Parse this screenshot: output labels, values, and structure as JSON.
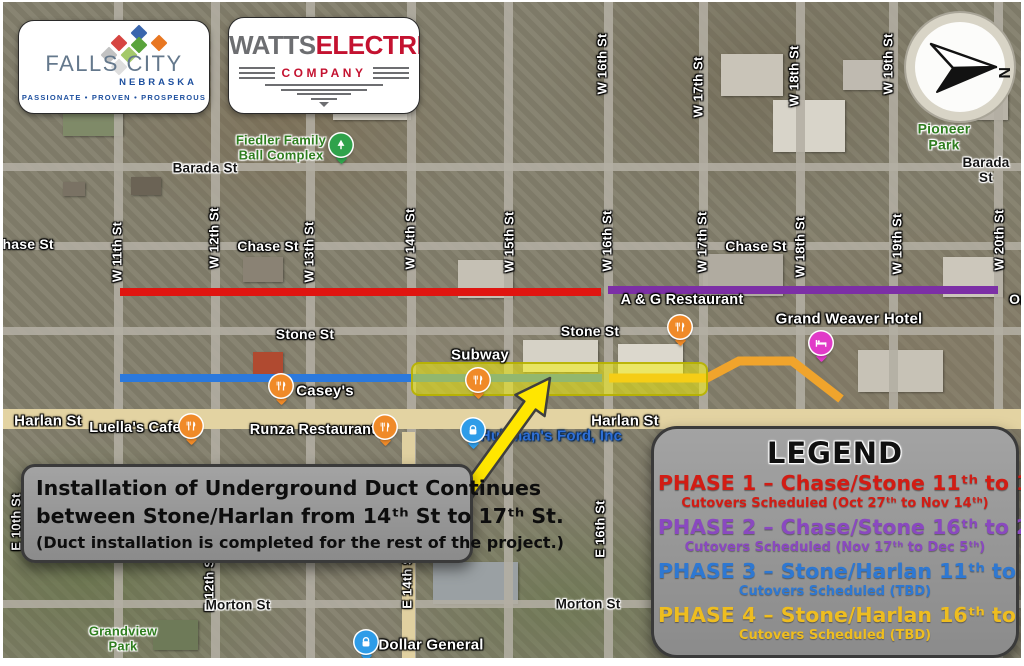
{
  "logos": {
    "falls_city": {
      "name": "FALLS CITY",
      "state": "NEBRASKA",
      "tagline": "PASSIONATE • PROVEN • PROSPEROUS"
    },
    "watts": {
      "word1": "WATTS",
      "word2": "ELECTRIC",
      "word3": "COMPANY"
    }
  },
  "compass": {
    "north_label": "N"
  },
  "annotation": {
    "line1": "Installation of Underground Duct Continues",
    "line2": "between Stone/Harlan from 14ᵗʰ St to 17ᵗʰ St.",
    "line3": "(Duct installation is completed for the rest of the project.)"
  },
  "legend": {
    "title": "LEGEND",
    "phases": [
      {
        "label": "PHASE 1 – Chase/Stone 11ᵗʰ to 16ᵗʰ",
        "schedule": "Cutovers Scheduled (Oct 27ᵗʰ to Nov 14ᵗʰ)",
        "color": "#d21c14"
      },
      {
        "label": "PHASE 2 – Chase/Stone 16ᵗʰ to 20ᵗʰ",
        "schedule": "Cutovers Scheduled (Nov 17ᵗʰ to Dec 5ᵗʰ)",
        "color": "#8a49c0"
      },
      {
        "label": "PHASE 3 – Stone/Harlan 11ᵗʰ to 16ᵗʰ",
        "schedule": "Cutovers Scheduled (TBD)",
        "color": "#2e78d2"
      },
      {
        "label": "PHASE 4 – Stone/Harlan 16ᵗʰ to 18ᵗʰ",
        "schedule": "Cutovers Scheduled (TBD)",
        "color": "#eebd20"
      }
    ]
  },
  "colors": {
    "phase1_line": "#e01510",
    "phase2_line": "#7c2fa6",
    "phase3_line": "#2b79dd",
    "phase4_line": "#f0a42c",
    "highlight_fill": "rgba(250,245,0,0.5)",
    "highlight_border": "rgba(182,176,0,0.9)",
    "arrow_fill": "#ffe600"
  },
  "map": {
    "labels": [
      {
        "text": "W 11th St",
        "x": 115,
        "y": 250,
        "v": true,
        "cls": "white",
        "size": 13,
        "name": "street-label-w-11th"
      },
      {
        "text": "W 12th St",
        "x": 212,
        "y": 236,
        "v": true,
        "cls": "white",
        "size": 13,
        "name": "street-label-w-12th"
      },
      {
        "text": "W 13th St",
        "x": 307,
        "y": 250,
        "v": true,
        "cls": "white",
        "size": 13,
        "name": "street-label-w-13th"
      },
      {
        "text": "W 14th St",
        "x": 408,
        "y": 237,
        "v": true,
        "cls": "white",
        "size": 13,
        "name": "street-label-w-14th"
      },
      {
        "text": "W 15th St",
        "x": 507,
        "y": 240,
        "v": true,
        "cls": "white",
        "size": 13,
        "name": "street-label-w-15th"
      },
      {
        "text": "W 16th St",
        "x": 605,
        "y": 239,
        "v": true,
        "cls": "white",
        "size": 13,
        "name": "street-label-w-16th"
      },
      {
        "text": "W 17th St",
        "x": 700,
        "y": 240,
        "v": true,
        "cls": "white",
        "size": 13,
        "name": "street-label-w-17th"
      },
      {
        "text": "W 18th St",
        "x": 798,
        "y": 245,
        "v": true,
        "cls": "white",
        "size": 13,
        "name": "street-label-w-18th"
      },
      {
        "text": "W 19th St",
        "x": 895,
        "y": 242,
        "v": true,
        "cls": "white",
        "size": 13,
        "name": "street-label-w-19th"
      },
      {
        "text": "W 20th St",
        "x": 997,
        "y": 238,
        "v": true,
        "cls": "white",
        "size": 13,
        "name": "street-label-w-20th"
      },
      {
        "text": "W 16th St",
        "x": 600,
        "y": 62,
        "v": true,
        "cls": "white",
        "size": 13,
        "name": "street-label-w-16th-north"
      },
      {
        "text": "W 17th St",
        "x": 696,
        "y": 85,
        "v": true,
        "cls": "white",
        "size": 13,
        "name": "street-label-w-17th-north"
      },
      {
        "text": "W 18th St",
        "x": 792,
        "y": 74,
        "v": true,
        "cls": "white",
        "size": 13,
        "name": "street-label-w-18th-north"
      },
      {
        "text": "W 19th St",
        "x": 886,
        "y": 62,
        "v": true,
        "cls": "white",
        "size": 13,
        "name": "street-label-w-19th-north"
      },
      {
        "text": "E 16th St",
        "x": 598,
        "y": 527,
        "v": true,
        "cls": "white",
        "size": 13,
        "name": "street-label-e-16th"
      },
      {
        "text": "E 14th St",
        "x": 405,
        "y": 578,
        "v": true,
        "cls": "white",
        "size": 13,
        "name": "street-label-e-14th"
      },
      {
        "text": "E 12th St",
        "x": 207,
        "y": 581,
        "v": true,
        "cls": "white",
        "size": 13,
        "name": "street-label-e-12th"
      },
      {
        "text": "E 10th St",
        "x": 14,
        "y": 520,
        "v": true,
        "cls": "white",
        "size": 13,
        "name": "street-label-e-10th"
      },
      {
        "text": "Barada St",
        "x": 202,
        "y": 166,
        "cls": "black",
        "size": 13.5,
        "name": "street-label-barada-west"
      },
      {
        "text": "Barada St",
        "x": 983,
        "y": 168,
        "cls": "black",
        "size": 13.5,
        "name": "street-label-barada-east"
      },
      {
        "text": "Chase St",
        "x": 20,
        "y": 243,
        "cls": "white",
        "size": 14,
        "name": "street-label-chase-west"
      },
      {
        "text": "Chase St",
        "x": 265,
        "y": 245,
        "cls": "white",
        "size": 14,
        "name": "street-label-chase-mid"
      },
      {
        "text": "Chase St",
        "x": 753,
        "y": 245,
        "cls": "white",
        "size": 14,
        "name": "street-label-chase-east"
      },
      {
        "text": "Stone St",
        "x": 302,
        "y": 333,
        "cls": "white",
        "size": 14,
        "name": "street-label-stone-west"
      },
      {
        "text": "Stone St",
        "x": 587,
        "y": 330,
        "cls": "white",
        "size": 14,
        "name": "street-label-stone-east"
      },
      {
        "text": "Harlan St",
        "x": 45,
        "y": 420,
        "cls": "white",
        "size": 15,
        "name": "street-label-harlan-west"
      },
      {
        "text": "Harlan St",
        "x": 622,
        "y": 420,
        "cls": "white",
        "size": 15,
        "name": "street-label-harlan-east"
      },
      {
        "text": "Morton St",
        "x": 235,
        "y": 603,
        "cls": "black",
        "size": 13.5,
        "name": "street-label-morton-west"
      },
      {
        "text": "Morton St",
        "x": 585,
        "y": 602,
        "cls": "black",
        "size": 13.5,
        "name": "street-label-morton-east"
      },
      {
        "text": "On",
        "x": 1016,
        "y": 298,
        "cls": "white",
        "size": 14,
        "name": "street-label-clipped-east"
      },
      {
        "text": "Fiedler Family\nBall Complex",
        "x": 278,
        "y": 146,
        "cls": "green",
        "size": 13,
        "name": "place-label-fiedler-ball-complex"
      },
      {
        "text": "Pioneer Park",
        "x": 941,
        "y": 135,
        "cls": "green",
        "size": 14,
        "name": "place-label-pioneer-park"
      },
      {
        "text": "Grandview\nPark",
        "x": 120,
        "y": 637,
        "cls": "green",
        "size": 13,
        "name": "place-label-grandview-park"
      },
      {
        "text": "A & G Restaurant",
        "x": 679,
        "y": 298,
        "cls": "white",
        "size": 14.5,
        "name": "place-label-ag-restaurant"
      },
      {
        "text": "Grand Weaver Hotel",
        "x": 846,
        "y": 318,
        "cls": "white",
        "size": 15,
        "name": "place-label-grand-weaver-hotel"
      },
      {
        "text": "Subway",
        "x": 477,
        "y": 354,
        "cls": "white",
        "size": 15,
        "name": "place-label-subway"
      },
      {
        "text": "Casey's",
        "x": 322,
        "y": 390,
        "cls": "white",
        "size": 15,
        "name": "place-label-caseys"
      },
      {
        "text": "Luella's Cafe",
        "x": 132,
        "y": 426,
        "cls": "white",
        "size": 14.5,
        "name": "place-label-luellas-cafe"
      },
      {
        "text": "Runza Restaurant",
        "x": 310,
        "y": 428,
        "cls": "white",
        "size": 14.5,
        "name": "place-label-runza-restaurant"
      },
      {
        "text": "Hullman's Ford, Inc",
        "x": 548,
        "y": 435,
        "cls": "blue",
        "size": 15,
        "name": "place-label-hullmans-ford"
      },
      {
        "text": "Dollar General",
        "x": 428,
        "y": 644,
        "cls": "white",
        "size": 15,
        "name": "place-label-dollar-general"
      }
    ],
    "pois": [
      {
        "icon": "tree",
        "color": "#2fa24b",
        "x": 338,
        "y": 143,
        "name": "tree-pin-icon"
      },
      {
        "icon": "restaurant",
        "color": "#f08a28",
        "x": 677,
        "y": 325,
        "name": "restaurant-pin-icon"
      },
      {
        "icon": "restaurant",
        "color": "#f08a28",
        "x": 475,
        "y": 378,
        "name": "restaurant-pin-icon"
      },
      {
        "icon": "restaurant",
        "color": "#f08a28",
        "x": 278,
        "y": 384,
        "name": "restaurant-pin-icon"
      },
      {
        "icon": "restaurant",
        "color": "#f08a28",
        "x": 188,
        "y": 424,
        "name": "restaurant-pin-icon"
      },
      {
        "icon": "restaurant",
        "color": "#f08a28",
        "x": 382,
        "y": 425,
        "name": "restaurant-pin-icon"
      },
      {
        "icon": "hotel",
        "color": "#e13ac8",
        "x": 818,
        "y": 341,
        "name": "hotel-pin-icon"
      },
      {
        "icon": "lock",
        "color": "#2e9ce8",
        "x": 470,
        "y": 428,
        "name": "lock-pin-icon"
      },
      {
        "icon": "lock",
        "color": "#2e9ce8",
        "x": 363,
        "y": 640,
        "name": "lock-pin-icon"
      }
    ],
    "segments": [
      {
        "x": 117,
        "y": 286,
        "w": 481,
        "color_key": "phase1_line",
        "name": "phase1-route-line"
      },
      {
        "x": 605,
        "y": 284,
        "w": 390,
        "color_key": "phase2_line",
        "name": "phase2-route-line"
      },
      {
        "x": 117,
        "y": 372,
        "w": 482,
        "color_key": "phase3_line",
        "name": "phase3-route-line"
      }
    ],
    "highlight": {
      "x": 408,
      "y": 360,
      "w": 293,
      "h": 30,
      "name": "duct-work-highlight"
    }
  }
}
